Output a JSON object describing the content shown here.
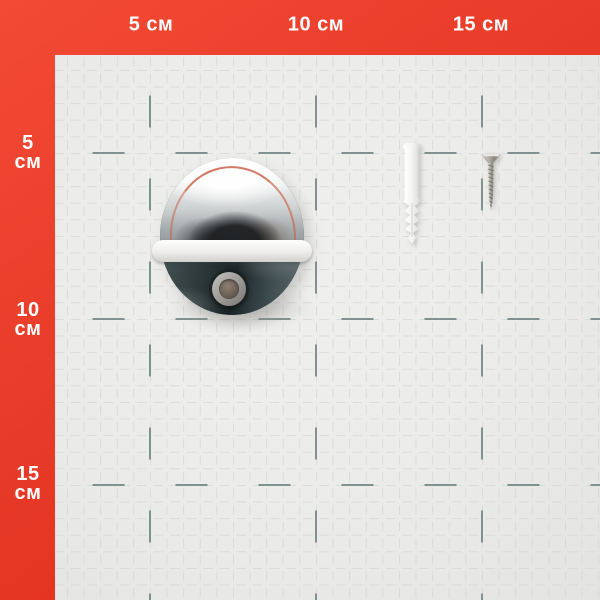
{
  "ruler": {
    "unit": "см",
    "top": [
      {
        "text": "5 см"
      },
      {
        "text": "10 см"
      },
      {
        "text": "15 см"
      }
    ],
    "left": [
      {
        "value": "5",
        "unit": "см"
      },
      {
        "value": "10",
        "unit": "см"
      },
      {
        "value": "15",
        "unit": "см"
      }
    ]
  },
  "scene": {
    "objects": [
      {
        "name": "chrome-door-stopper"
      },
      {
        "name": "wall-plug-dowel"
      },
      {
        "name": "mounting-screw"
      }
    ]
  },
  "colors": {
    "frame_red": "#e83a28",
    "frame_red_dark": "#dd2815",
    "label_text": "#ffffff",
    "paper": "#ebebe9",
    "minor_grid": "#d6d7d4",
    "major_grid": "#7f928f",
    "chrome_highlight": "#fafafa",
    "chrome_dark_bottom": "#1a2325",
    "red_reflection": "#ca6246",
    "bumper_band": "#f2f1ef",
    "plug_white": "#f6f6f4",
    "screw_metal": "#b0aaa2"
  }
}
